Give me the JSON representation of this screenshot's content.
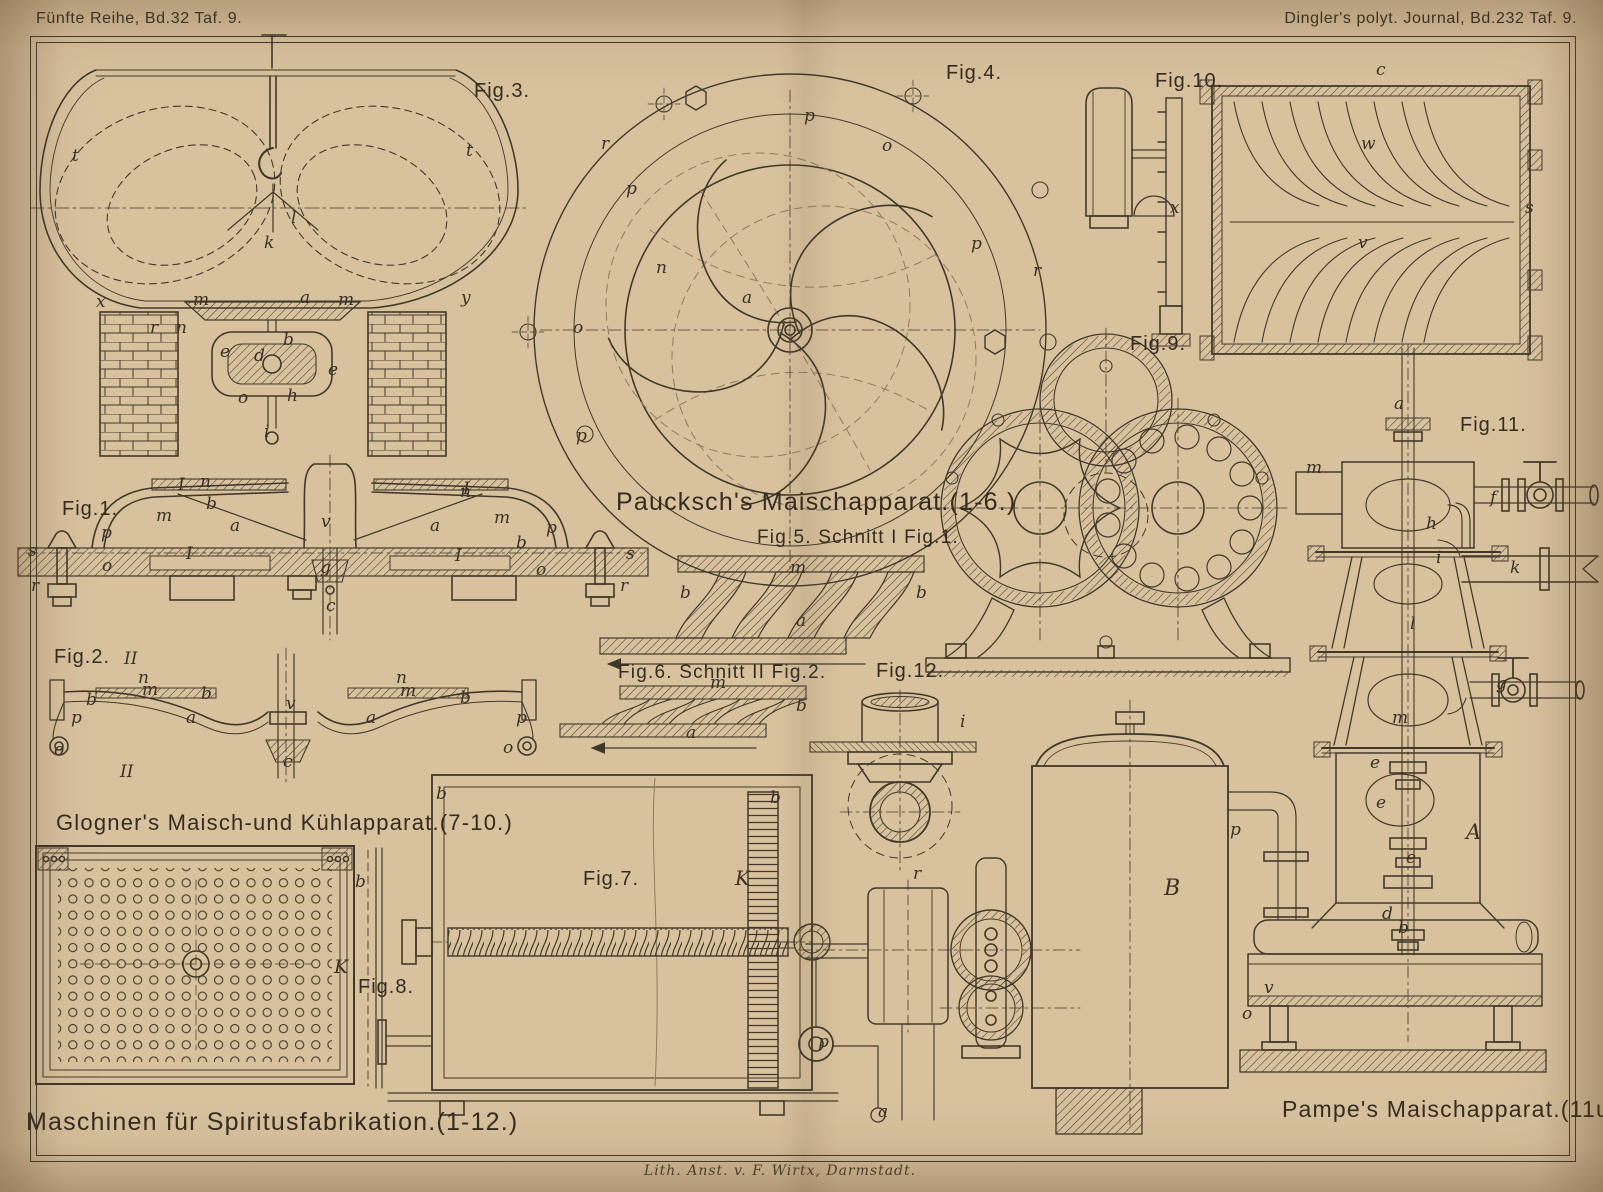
{
  "colors": {
    "paper": "#d8c29e",
    "ink": "#42382a",
    "faint": "#8d7c60"
  },
  "header": {
    "left": "Fünfte Reihe, Bd.32 Taf. 9.",
    "right": "Dingler's polyt. Journal, Bd.232 Taf. 9."
  },
  "footer": {
    "credit": "Lith. Anst. v. F. Wirtx, Darmstadt."
  },
  "captions": {
    "paucksch": "Paucksch's Maischapparat.(1-6.)",
    "fig5": "Fig.5. Schnitt I Fig.1.",
    "fig6": "Fig.6. Schnitt II Fig.2.",
    "glogner": "Glogner's Maisch-und Kühlapparat.(7-10.)",
    "maschinen": "Maschinen für Spiritusfabrikation.(1-12.)",
    "pampe": "Pampe's Maischapparat.(11u.12.)"
  },
  "figure_labels": [
    {
      "t": "Fig.1.",
      "x": 62,
      "y": 498
    },
    {
      "t": "Fig.2.",
      "x": 54,
      "y": 646
    },
    {
      "t": "Fig.3.",
      "x": 474,
      "y": 80
    },
    {
      "t": "Fig.4.",
      "x": 946,
      "y": 62
    },
    {
      "t": "Fig.7.",
      "x": 583,
      "y": 868
    },
    {
      "t": "Fig.8.",
      "x": 358,
      "y": 976
    },
    {
      "t": "Fig.9.",
      "x": 1130,
      "y": 333
    },
    {
      "t": "Fig.10.",
      "x": 1155,
      "y": 70
    },
    {
      "t": "Fig.11.",
      "x": 1460,
      "y": 414
    },
    {
      "t": "Fig.12.",
      "x": 876,
      "y": 660
    }
  ],
  "part_labels": [
    {
      "t": "t",
      "x": 72,
      "y": 148
    },
    {
      "t": "t",
      "x": 466,
      "y": 143
    },
    {
      "t": "l",
      "x": 291,
      "y": 210
    },
    {
      "t": "k",
      "x": 264,
      "y": 235
    },
    {
      "t": "x",
      "x": 96,
      "y": 294
    },
    {
      "t": "y",
      "x": 461,
      "y": 290
    },
    {
      "t": "m",
      "x": 193,
      "y": 292
    },
    {
      "t": "a",
      "x": 300,
      "y": 290
    },
    {
      "t": "m",
      "x": 338,
      "y": 292
    },
    {
      "t": "n",
      "x": 176,
      "y": 320
    },
    {
      "t": "r",
      "x": 150,
      "y": 320
    },
    {
      "t": "b",
      "x": 283,
      "y": 332
    },
    {
      "t": "e",
      "x": 220,
      "y": 344
    },
    {
      "t": "d",
      "x": 254,
      "y": 348
    },
    {
      "t": "e",
      "x": 328,
      "y": 362
    },
    {
      "t": "o",
      "x": 238,
      "y": 390
    },
    {
      "t": "h",
      "x": 287,
      "y": 388
    },
    {
      "t": "i",
      "x": 264,
      "y": 424
    },
    {
      "t": "r",
      "x": 601,
      "y": 136
    },
    {
      "t": "p",
      "x": 626,
      "y": 181
    },
    {
      "t": "p",
      "x": 804,
      "y": 108
    },
    {
      "t": "o",
      "x": 882,
      "y": 138
    },
    {
      "t": "n",
      "x": 656,
      "y": 260
    },
    {
      "t": "a",
      "x": 742,
      "y": 290
    },
    {
      "t": "o",
      "x": 573,
      "y": 320
    },
    {
      "t": "p",
      "x": 971,
      "y": 236
    },
    {
      "t": "r",
      "x": 1033,
      "y": 263
    },
    {
      "t": "p",
      "x": 576,
      "y": 428
    },
    {
      "t": "c",
      "x": 1376,
      "y": 62
    },
    {
      "t": "w",
      "x": 1361,
      "y": 136
    },
    {
      "t": "x",
      "x": 1170,
      "y": 200
    },
    {
      "t": "v",
      "x": 1358,
      "y": 235
    },
    {
      "t": "s",
      "x": 1525,
      "y": 200
    },
    {
      "t": "n",
      "x": 200,
      "y": 474
    },
    {
      "t": "b",
      "x": 206,
      "y": 496
    },
    {
      "t": "m",
      "x": 156,
      "y": 508
    },
    {
      "t": "a",
      "x": 230,
      "y": 518
    },
    {
      "t": "v",
      "x": 321,
      "y": 514
    },
    {
      "t": "a",
      "x": 430,
      "y": 518
    },
    {
      "t": "n",
      "x": 460,
      "y": 484
    },
    {
      "t": "m",
      "x": 494,
      "y": 510
    },
    {
      "t": "b",
      "x": 516,
      "y": 535
    },
    {
      "t": "p",
      "x": 101,
      "y": 525
    },
    {
      "t": "p",
      "x": 546,
      "y": 520
    },
    {
      "t": "s",
      "x": 28,
      "y": 543
    },
    {
      "t": "o",
      "x": 102,
      "y": 558
    },
    {
      "t": "g",
      "x": 320,
      "y": 560
    },
    {
      "t": "o",
      "x": 536,
      "y": 562
    },
    {
      "t": "s",
      "x": 626,
      "y": 546
    },
    {
      "t": "r",
      "x": 31,
      "y": 578
    },
    {
      "t": "r",
      "x": 620,
      "y": 578
    },
    {
      "t": "c",
      "x": 326,
      "y": 598
    },
    {
      "t": "I",
      "x": 178,
      "y": 477
    },
    {
      "t": "I",
      "x": 186,
      "y": 546
    },
    {
      "t": "I",
      "x": 463,
      "y": 481
    },
    {
      "t": "I",
      "x": 455,
      "y": 548
    },
    {
      "t": "II",
      "x": 124,
      "y": 651
    },
    {
      "t": "n",
      "x": 138,
      "y": 670
    },
    {
      "t": "m",
      "x": 142,
      "y": 682
    },
    {
      "t": "b",
      "x": 86,
      "y": 692
    },
    {
      "t": "b",
      "x": 201,
      "y": 686
    },
    {
      "t": "a",
      "x": 186,
      "y": 710
    },
    {
      "t": "v",
      "x": 286,
      "y": 696
    },
    {
      "t": "n",
      "x": 396,
      "y": 670
    },
    {
      "t": "m",
      "x": 400,
      "y": 683
    },
    {
      "t": "b",
      "x": 460,
      "y": 690
    },
    {
      "t": "a",
      "x": 366,
      "y": 710
    },
    {
      "t": "p",
      "x": 71,
      "y": 710
    },
    {
      "t": "p",
      "x": 516,
      "y": 710
    },
    {
      "t": "o",
      "x": 54,
      "y": 742
    },
    {
      "t": "o",
      "x": 503,
      "y": 740
    },
    {
      "t": "c",
      "x": 283,
      "y": 754
    },
    {
      "t": "II",
      "x": 120,
      "y": 764
    },
    {
      "t": "b",
      "x": 680,
      "y": 585
    },
    {
      "t": "m",
      "x": 790,
      "y": 560
    },
    {
      "t": "a",
      "x": 796,
      "y": 613
    },
    {
      "t": "b",
      "x": 916,
      "y": 585
    },
    {
      "t": "m",
      "x": 710,
      "y": 675
    },
    {
      "t": "a",
      "x": 686,
      "y": 725
    },
    {
      "t": "b",
      "x": 796,
      "y": 698
    },
    {
      "t": "i",
      "x": 960,
      "y": 714
    },
    {
      "t": "a",
      "x": 1394,
      "y": 396
    },
    {
      "t": "m",
      "x": 1306,
      "y": 460
    },
    {
      "t": "f",
      "x": 1490,
      "y": 490
    },
    {
      "t": "h",
      "x": 1426,
      "y": 516
    },
    {
      "t": "i",
      "x": 1436,
      "y": 550
    },
    {
      "t": "k",
      "x": 1510,
      "y": 560
    },
    {
      "t": "l",
      "x": 1410,
      "y": 616
    },
    {
      "t": "g",
      "x": 1496,
      "y": 676
    },
    {
      "t": "m",
      "x": 1392,
      "y": 710
    },
    {
      "t": "e",
      "x": 1370,
      "y": 755
    },
    {
      "t": "e",
      "x": 1376,
      "y": 795
    },
    {
      "t": "A",
      "x": 1466,
      "y": 822,
      "s": 21
    },
    {
      "t": "e",
      "x": 1406,
      "y": 850
    },
    {
      "t": "d",
      "x": 1382,
      "y": 906
    },
    {
      "t": "b",
      "x": 1398,
      "y": 920
    },
    {
      "t": "v",
      "x": 1264,
      "y": 980
    },
    {
      "t": "o",
      "x": 1242,
      "y": 1006
    },
    {
      "t": "p",
      "x": 1230,
      "y": 822
    },
    {
      "t": "b",
      "x": 436,
      "y": 786
    },
    {
      "t": "b",
      "x": 770,
      "y": 790
    },
    {
      "t": "K",
      "x": 735,
      "y": 868,
      "s": 20
    },
    {
      "t": "r",
      "x": 913,
      "y": 866
    },
    {
      "t": "p",
      "x": 818,
      "y": 1034
    },
    {
      "t": "a",
      "x": 878,
      "y": 1104
    },
    {
      "t": "b",
      "x": 355,
      "y": 874
    },
    {
      "t": "K",
      "x": 334,
      "y": 958,
      "s": 19
    },
    {
      "t": "B",
      "x": 1164,
      "y": 878,
      "s": 22
    }
  ]
}
